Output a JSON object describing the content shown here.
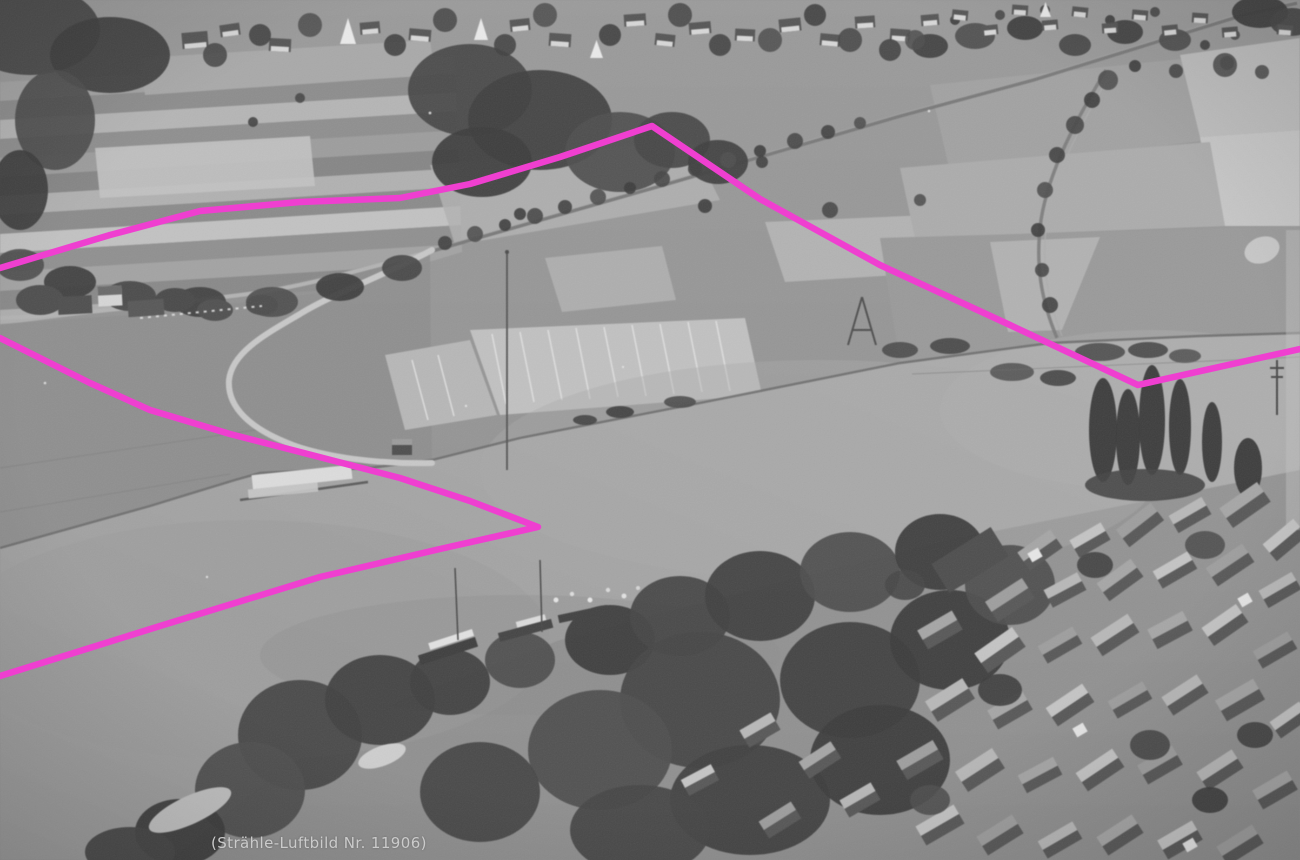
{
  "photo": {
    "caption": "(Strähle-Luftbild Nr. 11906)",
    "description": "Black-and-white oblique aerial photograph of a river flowing diagonally through the frame; villages line the top edge and the bottom-right, fields and tree-lined roads fill the upper half, a white winding road leads to a small landing pier, boats are moored on the near bank, and tall poplars stand at the right. A bright magenta boundary line is drawn over the print."
  },
  "annotation": {
    "color": "#ef3fd0",
    "stroke_width": 6.5,
    "polylines": [
      {
        "name": "upper-boundary-line",
        "points": "0,268 110,235 200,211 300,202 400,198 470,184 560,157 652,126 760,199 880,265 1010,325 1138,385 1300,349"
      },
      {
        "name": "lower-boundary-arrow-line",
        "points": "0,338 90,383 150,410 230,434 300,452 400,478 470,501 538,527 440,549 320,577 160,626 0,676"
      }
    ]
  },
  "palette": {
    "photo_light": "#c6c6c6",
    "photo_mid": "#949494",
    "photo_dark": "#474747",
    "water": "#a6a6a6",
    "caption_text": "#cbcbcb"
  }
}
